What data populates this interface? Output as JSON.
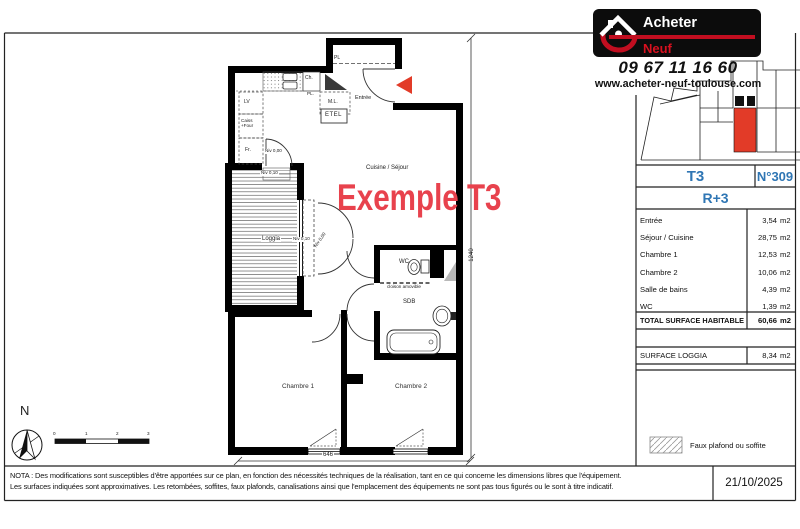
{
  "brand": {
    "name_top": "Acheter",
    "name_red": "Neuf ",
    "name_white": "Toulouse",
    "name_suffix": ".com",
    "phone": "09 67 11 16 60",
    "website": "www.acheter-neuf-toulouse.com"
  },
  "panel": {
    "type": "T3",
    "number": "N°309",
    "floor": "R+3",
    "unit": "m2",
    "rooms": [
      {
        "label": "Entrée",
        "area": "3,54"
      },
      {
        "label": "Séjour / Cuisine",
        "area": "28,75"
      },
      {
        "label": "Chambre 1",
        "area": "12,53"
      },
      {
        "label": "Chambre 2",
        "area": "10,06"
      },
      {
        "label": "Salle de bains",
        "area": "4,39"
      },
      {
        "label": "WC",
        "area": "1,39"
      }
    ],
    "total_label": "TOTAL SURFACE HABITABLE",
    "total_area": "60,66",
    "loggia_label": "SURFACE LOGGIA",
    "loggia_area": "8,34",
    "legend": "Faux plafond ou soffite"
  },
  "plan": {
    "watermark": "Exemple T3",
    "labels": {
      "cuisine": "Cuisine / Séjour",
      "loggia": "Loggia",
      "chambre1": "Chambre 1",
      "chambre2": "Chambre 2",
      "wc": "WC",
      "sdb": "SDB",
      "entree": "Entrée",
      "cloison": "cloison amovible",
      "pl": "PL",
      "pl2": "PL.",
      "ch": "Ch.",
      "lv": "LV",
      "caisson": "Caiss",
      "four": "+Four",
      "frigo": "Fr.",
      "ml": "M.L.",
      "etel": "ETEL",
      "niv000": "Niv 0,00",
      "niv010": "Niv 0,10"
    },
    "dims": {
      "width": "646",
      "height": "1240"
    },
    "compass_n": "N",
    "scale_ticks": [
      "0",
      "1",
      "2",
      "3"
    ]
  },
  "footer": {
    "nota1": "NOTA : Des modifications sont susceptibles d'être apportées sur ce plan, en fonction des nécessités techniques de la réalisation, tant en ce qui concerne les dimensions libres que l'équipement.",
    "nota2": "Les surfaces indiquées sont approximatives. Les retombées, soffites, faux plafonds, canalisations ainsi que l'emplacement des équipements ne sont pas tous figurés ou le sont à titre indicatif.",
    "date": "21/10/2025"
  },
  "colors": {
    "accent_red": "#e23b28",
    "watermark_red": "#e8424d",
    "blue": "#2f76b4",
    "logo_red": "#c10e20"
  }
}
